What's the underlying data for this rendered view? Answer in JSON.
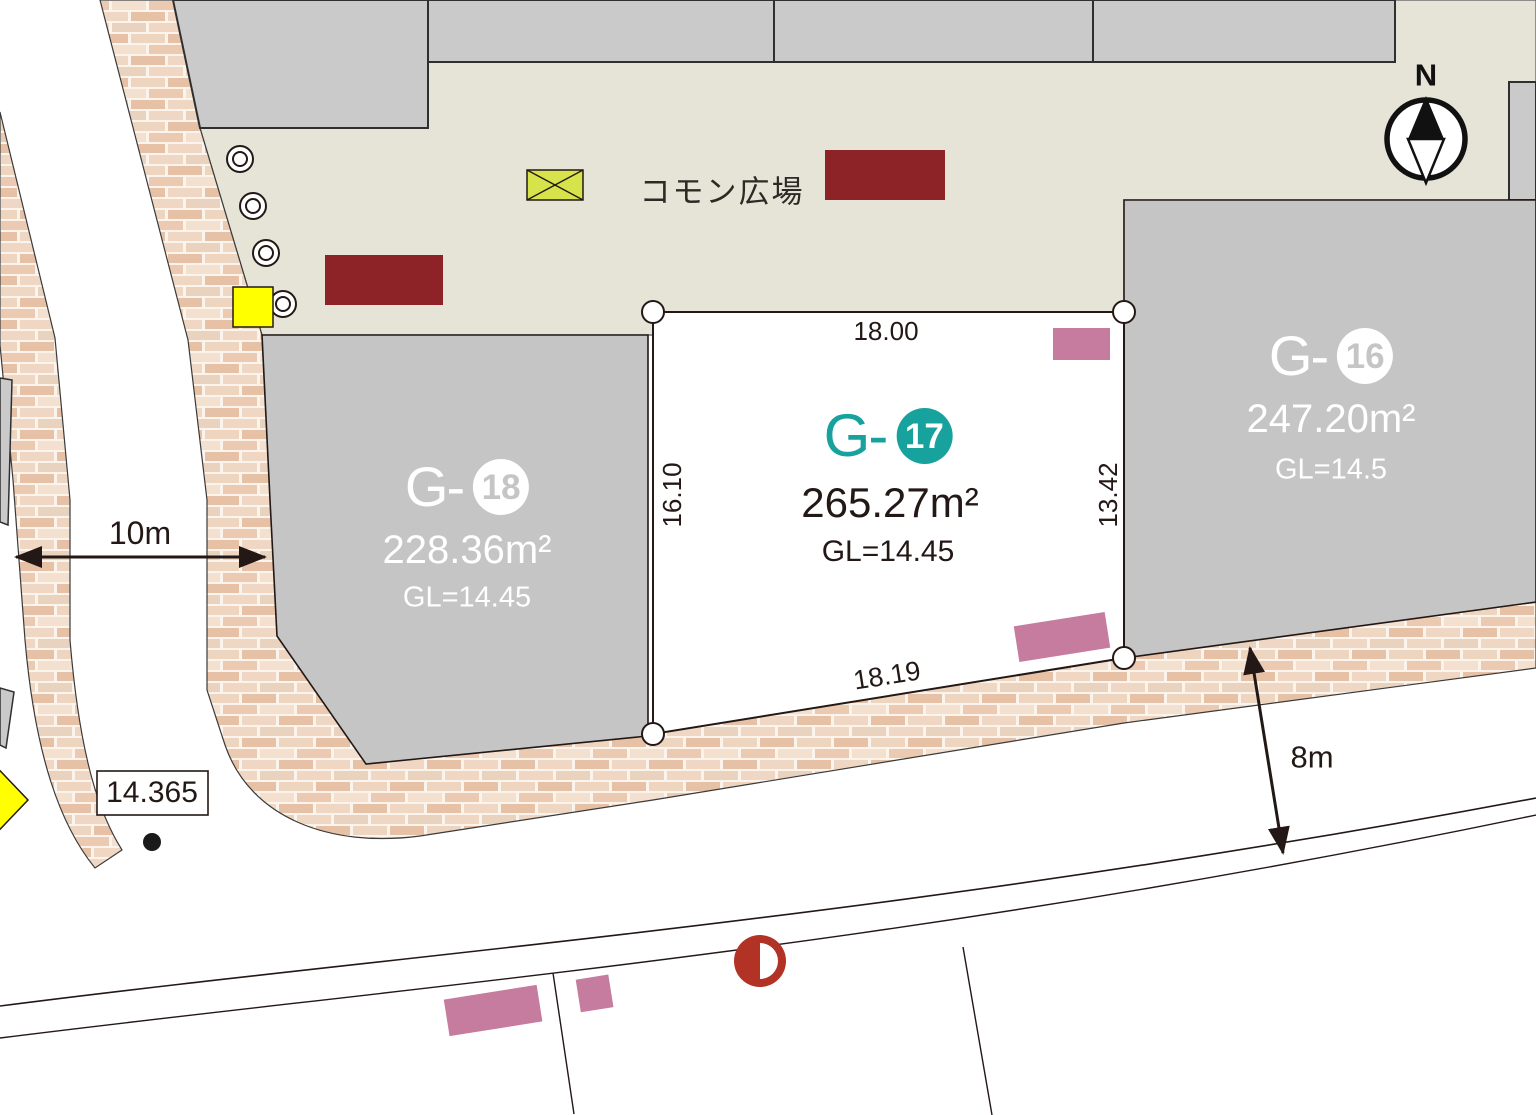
{
  "plaza": {
    "label": "コモン広場"
  },
  "compass": {
    "north": "N"
  },
  "lots": {
    "g17": {
      "prefix": "G-",
      "number": "17",
      "area": "265.27m²",
      "gl": "GL=14.45",
      "highlighted": true
    },
    "g16": {
      "prefix": "G-",
      "number": "16",
      "area": "247.20m²",
      "gl": "GL=14.5",
      "highlighted": false
    },
    "g18": {
      "prefix": "G-",
      "number": "18",
      "area": "228.36m²",
      "gl": "GL=14.45",
      "highlighted": false
    }
  },
  "dimensions": {
    "lot17_top": "18.00",
    "lot17_left": "16.10",
    "lot17_right": "13.42",
    "lot17_bottom": "18.19",
    "west_road_width": "10m",
    "south_road_width": "8m"
  },
  "benchmark": {
    "elevation": "14.365"
  },
  "colors": {
    "highlight_teal": "#17a29e",
    "lot_gray": "#c5c5c5",
    "building_gray": "#cacaca",
    "plaza_beige": "#e5e4d7",
    "bench_dark_red": "#8d2227",
    "marker_red": "#b23226",
    "parking_pink": "#c57c9e",
    "signal_yellow": "#ffff00",
    "xbox_yellow_green": "#d6e34b",
    "line_black": "#231815",
    "brick_mortar": "#fbf4ed"
  }
}
